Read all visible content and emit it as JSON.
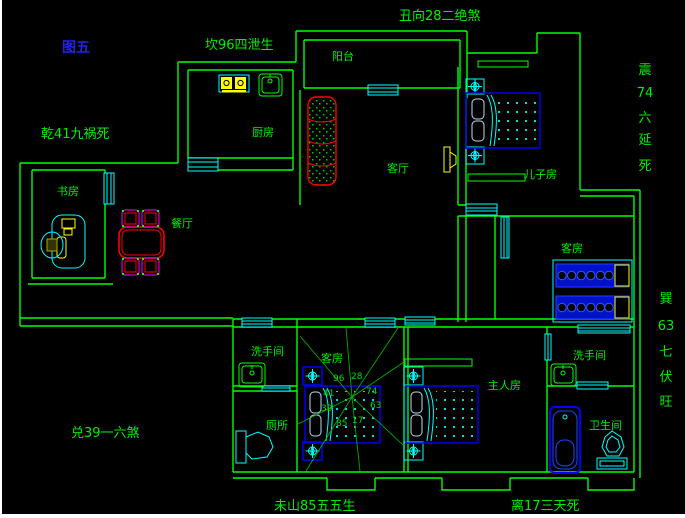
{
  "title": {
    "text": "图五",
    "color": "#2222EE"
  },
  "annotations": {
    "top": "丑向28二绝煞",
    "kan": "坎96四泄生",
    "qian": "乾41九祸死",
    "dui": "兑39一六煞",
    "wei": "未山85五五生",
    "li": "离17三天死",
    "zhen": [
      "震",
      "74",
      "六",
      "延",
      "死"
    ],
    "xun": [
      "巽",
      "63",
      "七",
      "伏",
      "旺"
    ]
  },
  "rooms": {
    "balcony": "阳台",
    "kitchen": "厨房",
    "living_room": "客厅",
    "sons_room": "儿子房",
    "study": "书房",
    "dining_room": "餐厅",
    "guest_room_right": "客房",
    "guest_room_center": "客房",
    "washroom_left": "洗手间",
    "washroom_right": "洗手间",
    "toilet": "厕所",
    "master_bedroom": "主人房",
    "bathroom": "卫生间"
  },
  "compass": {
    "n96": "96",
    "n28": "28",
    "n41": "41",
    "n74": "74",
    "n39": "39",
    "n63": "63",
    "n85": "85",
    "n17": "17"
  },
  "colors": {
    "background": "#000000",
    "wall": "#00FF00",
    "fixture": "#00FFFF",
    "furniture_blue": "#0000EE",
    "accent_red": "#FF0000",
    "accent_magenta": "#FF00FF",
    "accent_yellow": "#FFFF00",
    "label_green": "#00EE00",
    "title_blue": "#2222EE",
    "page_border": "#FFFFFF"
  }
}
